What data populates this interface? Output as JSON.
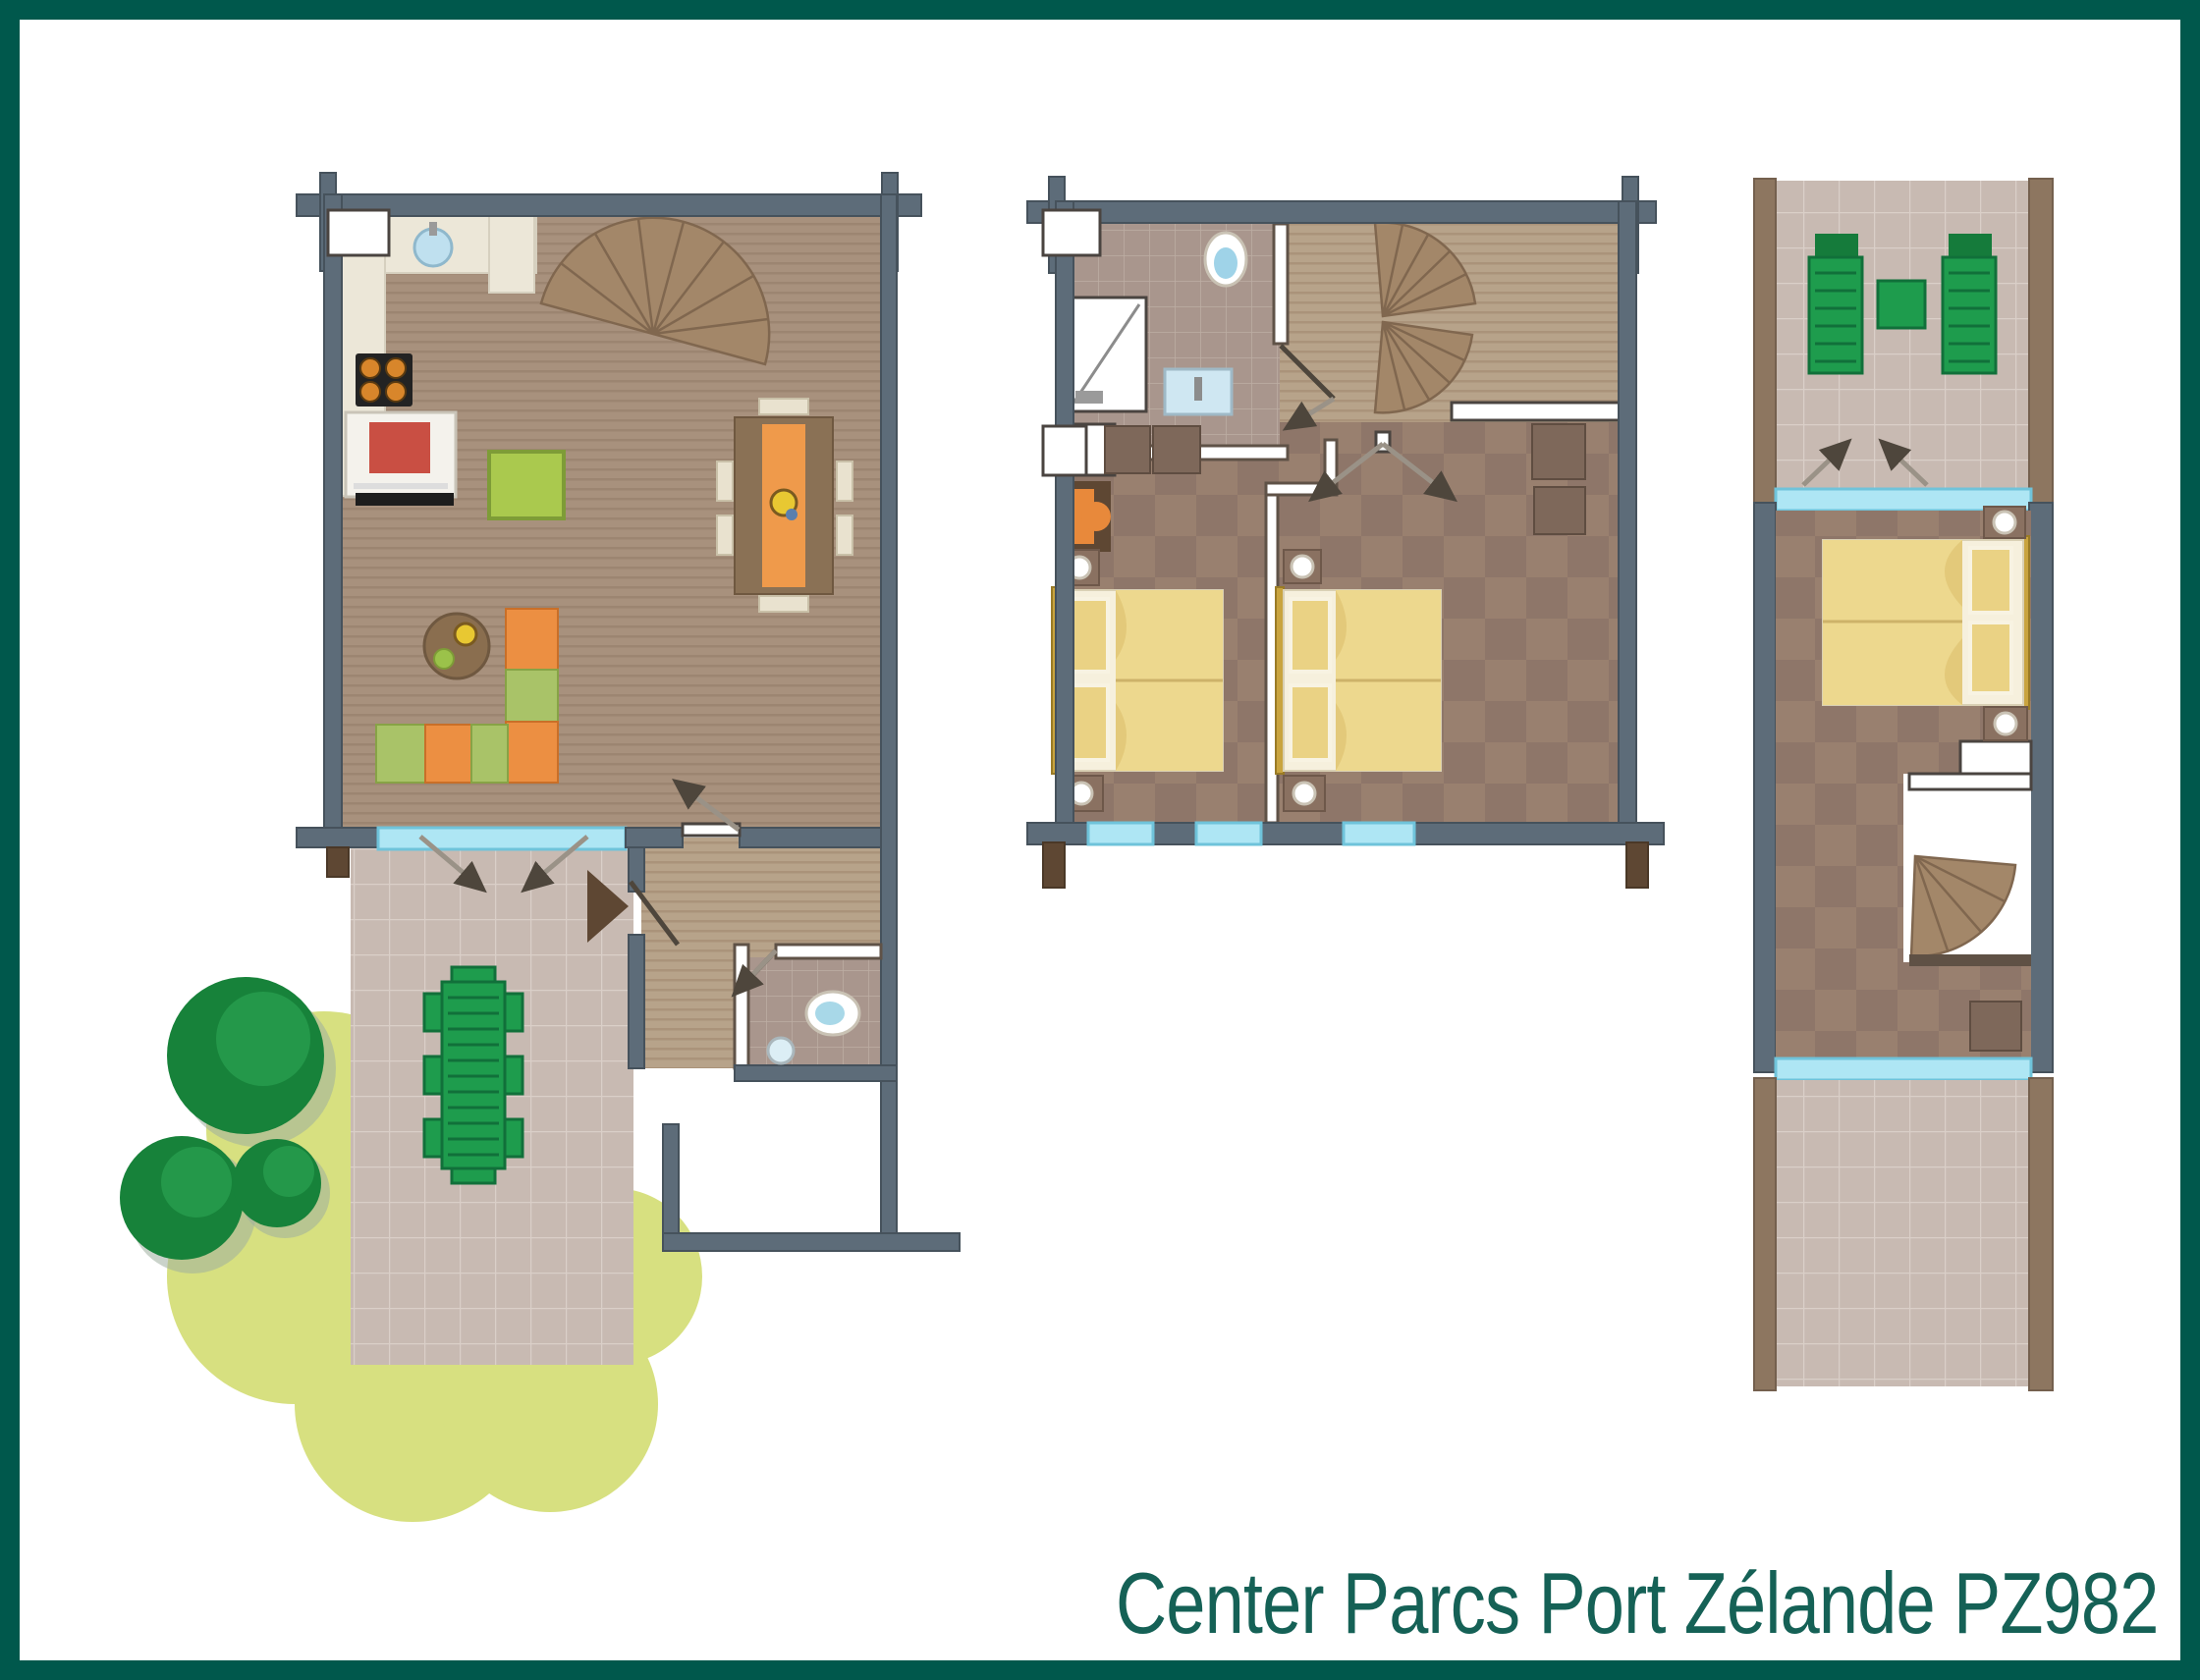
{
  "caption": {
    "text": "Center Parcs Port Zélande PZ982"
  },
  "colors": {
    "frame_teal": "#00584C",
    "caption_teal": "#156156",
    "wall_gray": "#5D6C79",
    "log_brown": "#5E4733",
    "window_blue": "#AEE6F4",
    "wood_floor": "#A8917D",
    "hall_wood": "#B7A38A",
    "carpet_brown": "#8E7669",
    "bathroom_tile": "#A9968D",
    "terrace_tile": "#C8BAB2",
    "grass_green": "#D7E080",
    "tree_green": "#17823A",
    "furniture_green": "#1E9C4D",
    "sofa_orange": "#EC8F42",
    "sofa_green": "#A9C368",
    "bed_yellow": "#EDD88E",
    "headboard_gold": "#C9A43F",
    "stair_wood": "#A38769",
    "accent_orange": "#EF9A4B"
  },
  "floors": [
    {
      "id": "ground-floor",
      "rooms": [
        "kitchen",
        "living-room",
        "hallway",
        "toilet",
        "storage",
        "terrace",
        "garden"
      ],
      "furniture": [
        "kitchen-sink",
        "stove",
        "oven",
        "side-table",
        "dining-table-with-6-chairs",
        "corner-sofa",
        "coffee-table",
        "spiral-staircase",
        "toilet",
        "garden-dining-set",
        "front-door",
        "sliding-door",
        "trees",
        "lawn"
      ]
    },
    {
      "id": "first-floor",
      "rooms": [
        "bathroom",
        "landing",
        "bedroom-1",
        "bedroom-2"
      ],
      "furniture": [
        "shower",
        "toilet",
        "washbasin",
        "spiral-staircase",
        "double-bed",
        "double-bed",
        "wardrobes",
        "armchair",
        "windows"
      ]
    },
    {
      "id": "top-floor",
      "rooms": [
        "balcony",
        "bedroom-3",
        "stair-landing",
        "roof-terrace"
      ],
      "furniture": [
        "sun-loungers",
        "balcony-table",
        "double-bed",
        "spiral-staircase",
        "wardrobe",
        "sliding-doors"
      ]
    }
  ]
}
